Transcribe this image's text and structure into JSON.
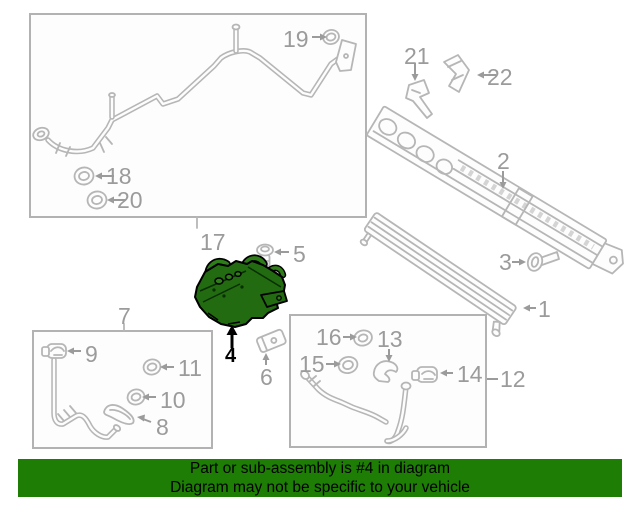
{
  "banner": {
    "line1": "Part or sub-assembly is #4 in diagram",
    "line2": "Diagram may not be specific to your vehicle"
  },
  "highlighted_callout": "4",
  "callouts": {
    "c1": "1",
    "c2": "2",
    "c3": "3",
    "c4": "4",
    "c5": "5",
    "c6": "6",
    "c7": "7",
    "c8": "8",
    "c9": "9",
    "c10": "10",
    "c11": "11",
    "c12": "12",
    "c13": "13",
    "c14": "14",
    "c15": "15",
    "c16": "16",
    "c17": "17",
    "c18": "18",
    "c19": "19",
    "c20": "20",
    "c21": "21",
    "c22": "22"
  },
  "colors": {
    "outline_gray": "#b6b6b6",
    "label_gray": "#9b9b9b",
    "highlight_fill": "#226b10",
    "highlight_stroke": "#000000",
    "banner_bg": "#1e7d05",
    "banner_text": "#000000"
  }
}
